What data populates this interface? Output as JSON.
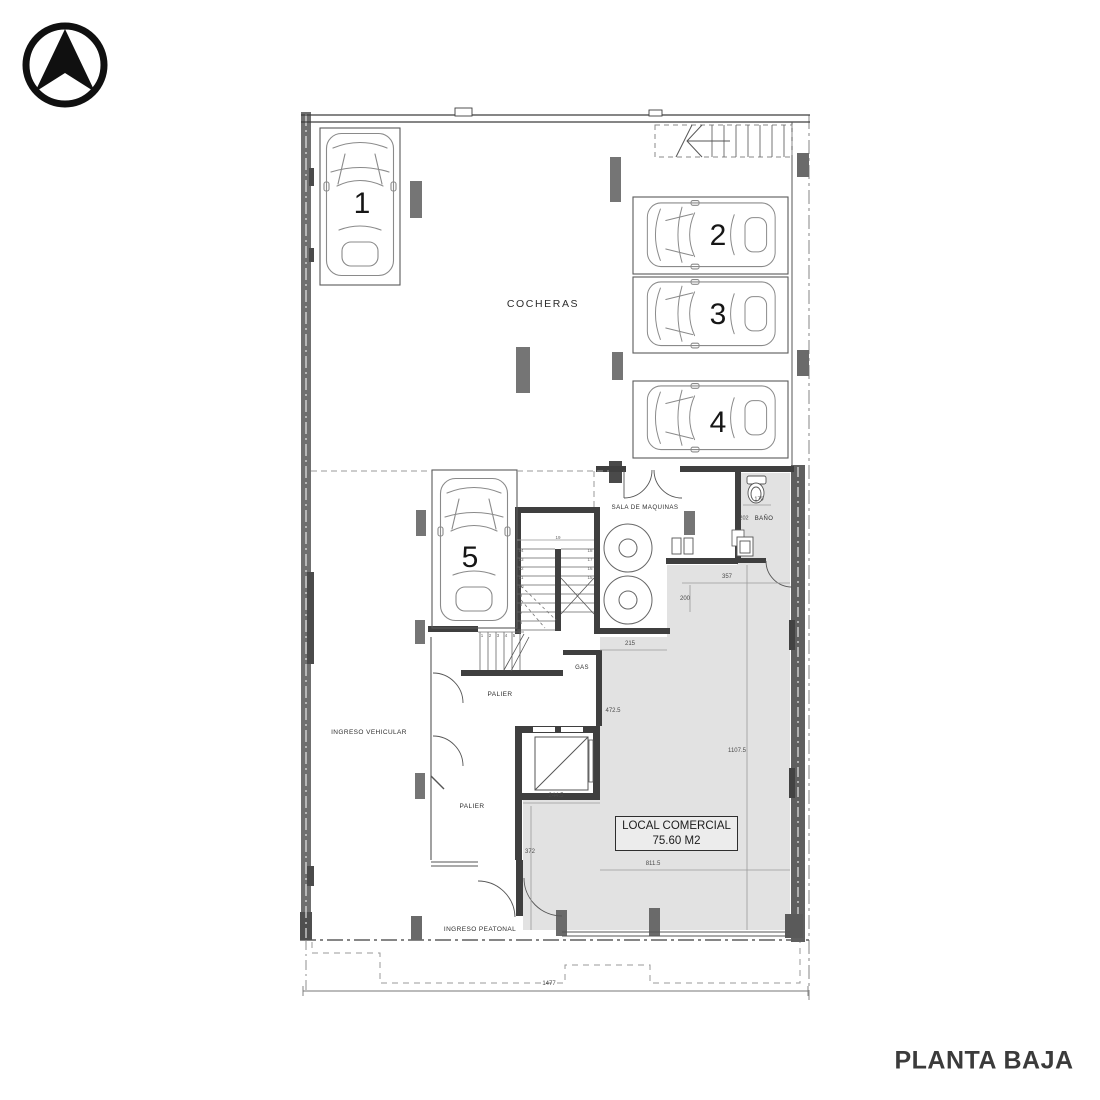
{
  "title": "PLANTA BAJA",
  "north_arrow": {
    "icon": "north-arrow"
  },
  "garage": {
    "label": "COCHERAS",
    "spots": [
      "1",
      "2",
      "3",
      "4",
      "5"
    ]
  },
  "rooms": {
    "machine_room": "SALA DE MAQUINAS",
    "bathroom": "BAÑO",
    "gas": "GAS",
    "landing_upper": "PALIER",
    "landing_lower": "PALIER",
    "vehicle_entry": "INGRESO VEHICULAR",
    "pedestrian_entry": "INGRESO PEATONAL"
  },
  "commercial_unit": {
    "line1": "LOCAL COMERCIAL",
    "line2": "75.60 M2"
  },
  "dimensions": {
    "bath_depth": "170",
    "bath_width": "202",
    "d357": "357",
    "d200": "200",
    "d215": "215",
    "d472_5": "472.5",
    "d1107_5": "1107.5",
    "d244_5": "244.5",
    "d372": "372",
    "d811_5": "811.5",
    "total_width": "1477"
  },
  "stairs": {
    "top": "19",
    "left_flight": [
      "14",
      "13",
      "12",
      "11",
      "10",
      "9",
      "8",
      "7",
      "6"
    ],
    "right_flight": [
      "18",
      "17",
      "16",
      "15"
    ],
    "bottom_flight": [
      "1",
      "2",
      "3",
      "4",
      "5"
    ]
  },
  "colors": {
    "wall_dark": "#3f3f3f",
    "wall_medium": "#6f6f6f",
    "column": "#757575",
    "shading": "#e2e2e2",
    "line": "#555555",
    "title_text": "#3b3b3b"
  }
}
